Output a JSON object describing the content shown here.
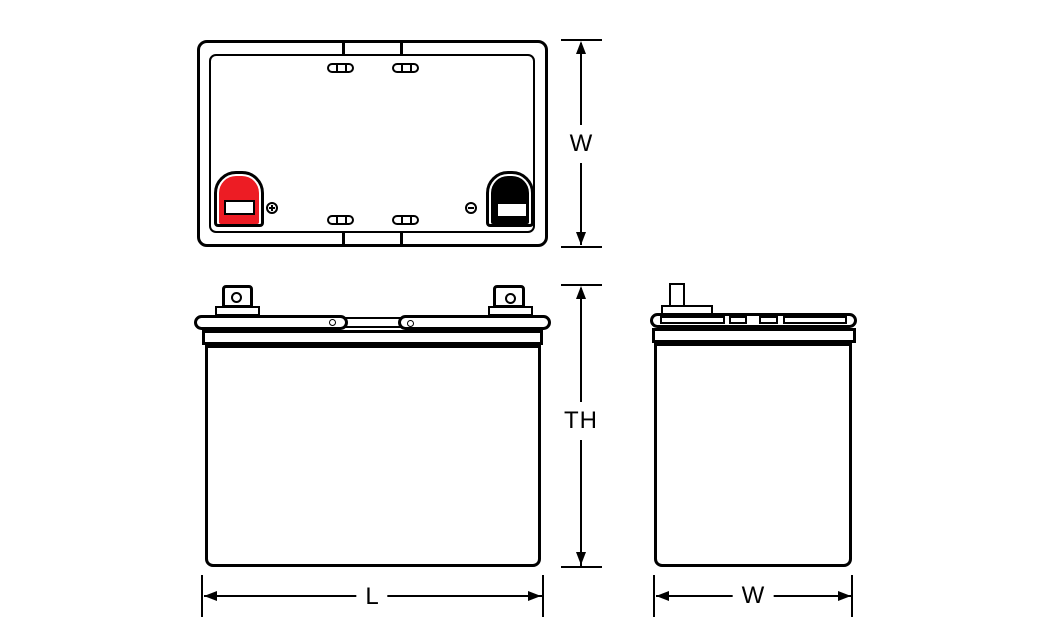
{
  "diagram": {
    "labels": {
      "top_view_width": "W",
      "front_view_total_height": "TH",
      "front_view_length": "L",
      "side_view_width": "W"
    },
    "colors": {
      "positive_terminal": "#ed1c24",
      "negative_terminal": "#000000",
      "line": "#000000",
      "background": "#ffffff"
    },
    "icons": {
      "positive_polarity": "plus-circle-icon",
      "negative_polarity": "minus-circle-icon"
    }
  }
}
